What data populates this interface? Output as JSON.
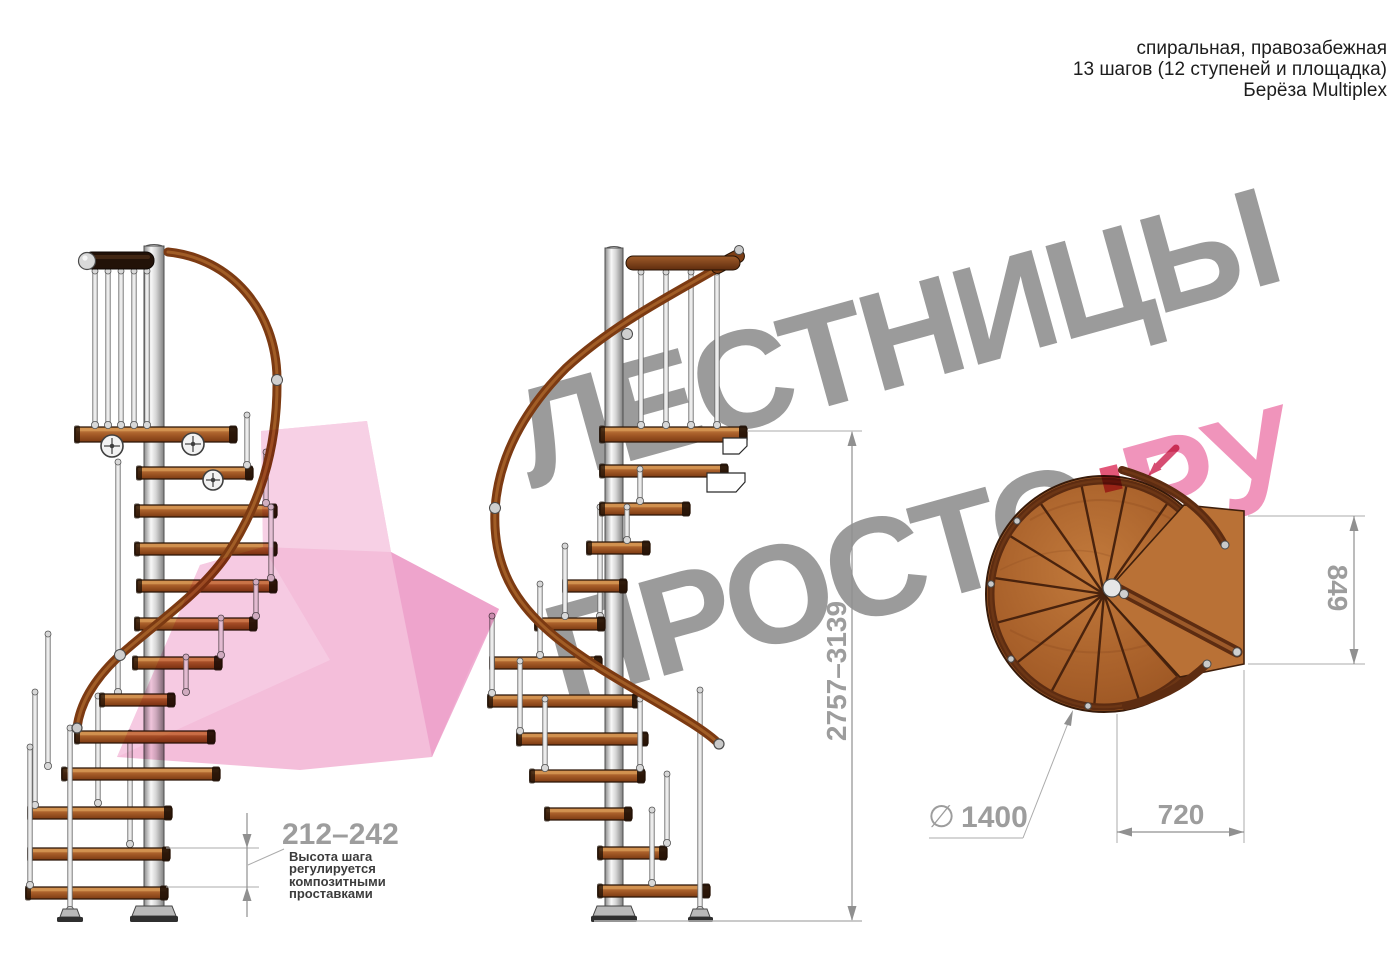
{
  "header": {
    "line1": "спиральная, правозабежная",
    "line2": "13 шагов (12 ступеней и площадка)",
    "line3": "Берёза Multiplex"
  },
  "watermark": {
    "word1": "ЛЕСТНИЦЫ",
    "word2": "ПРОСТО",
    "dot": ".",
    "word3": "РУ"
  },
  "dims": {
    "step_height": {
      "value": "212–242",
      "note1": "Высота шага",
      "note2": "регулируется",
      "note3": "композитными",
      "note4": "проставками"
    },
    "total_height": "2757–3139",
    "plan_depth": "849",
    "plan_width": "720",
    "diameter_symbol": "∅",
    "diameter_value": "1400"
  },
  "colors": {
    "watermark_gray": "#9b9b9b",
    "watermark_pink": "#f094bb",
    "accent_red": "#e0486e",
    "arrow_pink": "#f2b3d4",
    "dim_gray": "#9d9d9d"
  }
}
